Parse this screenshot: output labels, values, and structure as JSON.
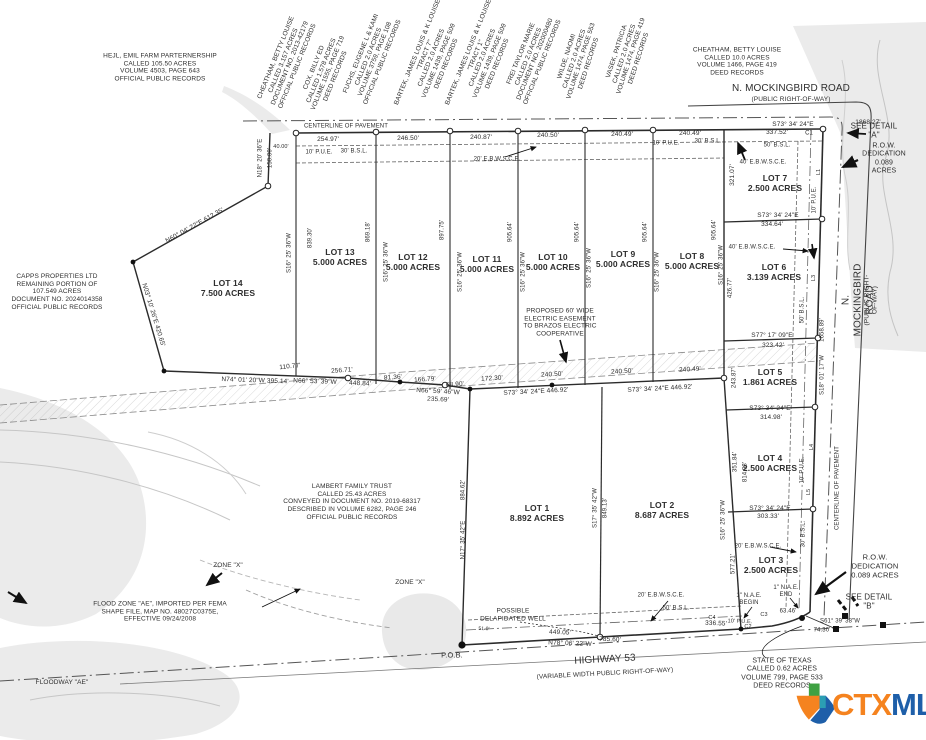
{
  "logo": {
    "ctx": "CTX",
    "mls": "MLS",
    "orange": "#F5831F",
    "blue": "#1E5FA9",
    "green": "#3FA142"
  },
  "annotations": [
    {
      "name": "owner-hejl",
      "text": "HEJL, EMIL FARM PARTERNERSHIP\nCALLED 105.50 ACRES\nVOLUME 4503, PAGE 643\nOFFICIAL PUBLIC RECORDS",
      "x": 160,
      "y": 68
    },
    {
      "name": "owner-cheatham-west",
      "text": "CHEATHAM, BETTY LOUISE\nCALLED 3.157 ACRES\nDOCUMENT NO. 2013-42179\nOFFICIAL PUBLIC RECORDS",
      "x": 287,
      "y": 62,
      "rot": -68
    },
    {
      "name": "owner-cox",
      "text": "COX, BILLY ED\nCALLED 1.578 ACRES\nVOLUME 1555, PAGE 719\nDEED RECORDS",
      "x": 325,
      "y": 72,
      "rot": -68
    },
    {
      "name": "owner-fuchs",
      "text": "FUCHS, EUGENE L & KAMI\nCALLED 2.0 ACRES\nVOLUME 3759, PAGE 108\nOFFICIAL PUBLIC RECORDS",
      "x": 372,
      "y": 58,
      "rot": -68
    },
    {
      "name": "owner-bartek-tract7",
      "text": "BARTEK, JAMES LOUIS & K LOUISE\n\"TRACT 7\"\nCALLED 2.0 ACRES\nVOLUME 1439, PAGE 509\nDEED RECORDS",
      "x": 432,
      "y": 58,
      "rot": -68
    },
    {
      "name": "owner-bartek-tract1",
      "text": "BARTEK, JAMES LOUIS & K LOUISE\n\"TRACT 1\"\nCALLED 2.0 ACRES\nVOLUME 1439, PAGE 509\nDEED RECORDS",
      "x": 483,
      "y": 58,
      "rot": -68
    },
    {
      "name": "owner-frei",
      "text": "FREI TAYLOR MARIE\nCALLED 2.0 ACRES\nDOCUMENT NO. 202000480\nOFFICIAL PUBLIC RECORDS",
      "x": 532,
      "y": 58,
      "rot": -68
    },
    {
      "name": "owner-wilde",
      "text": "WILDE, NAOMI\nCALLED 2.0 ACRES\nVOLUME 1474, PAGE 553\nDEED RECORDS",
      "x": 578,
      "y": 60,
      "rot": -72
    },
    {
      "name": "owner-vasek",
      "text": "VASEK, PATRICIA\nCALLED 2.0 ACRES\nVOLUME 1474, PAGE 419\nDEED RECORDS",
      "x": 628,
      "y": 55,
      "rot": -72
    },
    {
      "name": "owner-cheatham-east",
      "text": "CHEATHAM, BETTY LOUISE\nCALLED 10.0 ACRES\nVOLUME 1466, PAGE 419\nDEED RECORDS",
      "x": 737,
      "y": 62
    },
    {
      "name": "owner-capps",
      "text": "CAPPS PROPERTIES LTD\nREMAINING PORTION OF\n107.549 ACRES\nDOCUMENT NO. 2024014358\nOFFICIAL PUBLIC RECORDS",
      "x": 57,
      "y": 292
    },
    {
      "name": "owner-lambert",
      "text": "LAMBERT FAMILY TRUST\nCALLED 25.43 ACRES\nCONVEYED IN DOCUMENT NO. 2019-68317\nDESCRIBED IN VOLUME 6282, PAGE 246\nOFFICIAL PUBLIC RECORDS",
      "x": 352,
      "y": 502
    },
    {
      "name": "owner-state-of-texas",
      "text": "STATE OF TEXAS\nCALLED 0.62  ACRES\nVOLUME 799, PAGE 533\nDEED RECORDS",
      "x": 782,
      "y": 674,
      "fs": 7
    },
    {
      "name": "road-mockingbird-top",
      "text": "N. MOCKINGBIRD ROAD",
      "x": 791,
      "y": 89,
      "fs": 10
    },
    {
      "name": "road-mockingbird-top-sub",
      "text": "(PUBLIC RIGHT-OF-WAY)",
      "x": 791,
      "y": 100,
      "fs": 6.5
    },
    {
      "name": "road-mockingbird-right",
      "text": "N. MOCKINGBIRD ROAD",
      "x": 858,
      "y": 300,
      "rot": -90,
      "fs": 10
    },
    {
      "name": "road-mockingbird-right-sub",
      "text": "(PUBLIC RIGHT-OF-WAY)",
      "x": 871,
      "y": 300,
      "rot": -90,
      "fs": 6.5
    },
    {
      "name": "road-highway-53",
      "text": "HIGHWAY 53",
      "x": 605,
      "y": 660,
      "fs": 10,
      "rot": -3
    },
    {
      "name": "road-highway-53-sub",
      "text": "(VARIABLE WIDTH PUBLIC RIGHT-OF-WAY)",
      "x": 605,
      "y": 674,
      "fs": 6.5,
      "rot": -3
    },
    {
      "name": "centerline-of-pavement-top",
      "text": "CENTERLINE OF PAVEMENT",
      "x": 346,
      "y": 127,
      "fs": 6
    },
    {
      "name": "centerline-of-pavement-right",
      "text": "CENTERLINE OF PAVEMENT",
      "x": 838,
      "y": 488,
      "rot": -90,
      "fs": 6
    },
    {
      "name": "see-detail-a",
      "text": "SEE DETAIL\n\"A\"",
      "x": 874,
      "y": 131,
      "fs": 8
    },
    {
      "name": "row-dedication-top",
      "text": "R.O.W. DEDICATION\n0.089 ACRES",
      "x": 884,
      "y": 159,
      "fs": 7
    },
    {
      "name": "row-dedication-bottom",
      "text": "R.O.W. DEDICATION\n0.089 ACRES",
      "x": 875,
      "y": 567,
      "fs": 7.5
    },
    {
      "name": "see-detail-b",
      "text": "SEE DETAIL\n\"B\"",
      "x": 869,
      "y": 602,
      "fs": 8
    },
    {
      "name": "dim-s73-top",
      "text": "S73° 34' 24\"E",
      "x": 793,
      "y": 125
    },
    {
      "name": "dim-1868",
      "text": "1868.27'",
      "x": 868,
      "y": 123
    },
    {
      "name": "dim-40-00",
      "text": "40.00'",
      "x": 281,
      "y": 147,
      "fs": 5.5
    },
    {
      "name": "dim-254-97",
      "text": "254.97'",
      "x": 328,
      "y": 140
    },
    {
      "name": "pue-10-topleft",
      "text": "10' P.U.E.",
      "x": 319,
      "y": 153,
      "fs": 6
    },
    {
      "name": "bsl-30-topleft",
      "text": "30' B.S.L.",
      "x": 354,
      "y": 152,
      "fs": 6
    },
    {
      "name": "dim-246-50",
      "text": "246.50'",
      "x": 408,
      "y": 139
    },
    {
      "name": "ebwsce-20-top",
      "text": "20' E.B.W.S.C.E.",
      "x": 497,
      "y": 160,
      "fs": 6
    },
    {
      "name": "dim-240-87",
      "text": "240.87'",
      "x": 481,
      "y": 138
    },
    {
      "name": "dim-240-50-top",
      "text": "240.50'",
      "x": 548,
      "y": 136
    },
    {
      "name": "dim-240-49-a",
      "text": "240.49'",
      "x": 622,
      "y": 135
    },
    {
      "name": "dim-240-49-b",
      "text": "240.49'",
      "x": 690,
      "y": 134
    },
    {
      "name": "dim-337-52",
      "text": "337.52'",
      "x": 777,
      "y": 133
    },
    {
      "name": "curve-c1",
      "text": "C1",
      "x": 809,
      "y": 134,
      "fs": 6
    },
    {
      "name": "pue-10-topright",
      "text": "10' P.U.E.",
      "x": 666,
      "y": 144,
      "fs": 6
    },
    {
      "name": "bsl-30-topright",
      "text": "30' B.S.L.",
      "x": 708,
      "y": 142,
      "fs": 6
    },
    {
      "name": "bsl-50-lot7",
      "text": "50' B.S.L.",
      "x": 777,
      "y": 146,
      "fs": 6
    },
    {
      "name": "ebwsce-40-lot7",
      "text": "40' E.B.W.S.C.E.",
      "x": 763,
      "y": 163,
      "fs": 6
    },
    {
      "name": "dim-321-07",
      "text": "321.07'",
      "x": 733,
      "y": 175,
      "rot": -90
    },
    {
      "name": "lot7-label",
      "text": "LOT 7\n2.500 ACRES",
      "x": 775,
      "y": 183,
      "fs": 8.5,
      "bold": true
    },
    {
      "name": "dim-s73-lot7",
      "text": "S73° 34' 24\"E",
      "x": 778,
      "y": 216
    },
    {
      "name": "dim-334-64",
      "text": "334.64'",
      "x": 772,
      "y": 225
    },
    {
      "name": "ebwsce-40-lot6",
      "text": "40' E.B.W.S.C.E.",
      "x": 752,
      "y": 248,
      "fs": 6
    },
    {
      "name": "lot6-label",
      "text": "LOT 6\n3.139 ACRES",
      "x": 774,
      "y": 272,
      "fs": 8.5,
      "bold": true
    },
    {
      "name": "bsl-50-lot6",
      "text": "50' B.S.L.",
      "x": 803,
      "y": 310,
      "rot": -90,
      "fs": 6
    },
    {
      "name": "pue-10-right-upper",
      "text": "10' P.U.E.",
      "x": 815,
      "y": 200,
      "rot": -90,
      "fs": 6
    },
    {
      "name": "line-l1",
      "text": "L1",
      "x": 819,
      "y": 172,
      "rot": -90,
      "fs": 5.5
    },
    {
      "name": "dim-s77-17-09",
      "text": "S77° 17' 09\"E",
      "x": 772,
      "y": 336
    },
    {
      "name": "dim-323-42",
      "text": "323.42'",
      "x": 773,
      "y": 346
    },
    {
      "name": "lot5-label",
      "text": "LOT 5\n1.861 ACRES",
      "x": 770,
      "y": 377,
      "fs": 8.5,
      "bold": true
    },
    {
      "name": "dim-s73-lot5",
      "text": "S73° 34' 24\"E",
      "x": 770,
      "y": 409
    },
    {
      "name": "dim-314-98",
      "text": "314.98'",
      "x": 771,
      "y": 418
    },
    {
      "name": "lot4-label",
      "text": "LOT 4\n2.500 ACRES",
      "x": 770,
      "y": 463,
      "fs": 8.5,
      "bold": true
    },
    {
      "name": "dim-s73-lot4",
      "text": "S73° 34' 24\"E",
      "x": 770,
      "y": 509
    },
    {
      "name": "dim-303-33",
      "text": "303.33'",
      "x": 768,
      "y": 517
    },
    {
      "name": "lot3-label",
      "text": "LOT 3\n2.500 ACRES",
      "x": 771,
      "y": 565,
      "fs": 8.5,
      "bold": true
    },
    {
      "name": "ebwsce-20-lot3",
      "text": "20' E.B.W.S.C.E.",
      "x": 758,
      "y": 547,
      "fs": 6
    },
    {
      "name": "bsl-30-lot3",
      "text": "30' B.S.L.",
      "x": 804,
      "y": 534,
      "rot": -90,
      "fs": 6
    },
    {
      "name": "dim-243-87",
      "text": "243.87'",
      "x": 735,
      "y": 378,
      "rot": -90,
      "fs": 6
    },
    {
      "name": "dim-351-84",
      "text": "351.84'",
      "x": 736,
      "y": 462,
      "rot": -90,
      "fs": 6
    },
    {
      "name": "dim-814-98",
      "text": "814.98'",
      "x": 746,
      "y": 472,
      "rot": -90,
      "fs": 6
    },
    {
      "name": "dim-s16-lot3",
      "text": "S16° 25' 36\"W",
      "x": 724,
      "y": 520,
      "rot": -90,
      "fs": 6
    },
    {
      "name": "dim-577-21",
      "text": "577.21'",
      "x": 734,
      "y": 564,
      "rot": -90,
      "fs": 6
    },
    {
      "name": "dim-s18-01-17",
      "text": "S18° 01' 17\"W",
      "x": 823,
      "y": 375,
      "rot": -90,
      "fs": 6
    },
    {
      "name": "dim-1658-89",
      "text": "1658.89'",
      "x": 823,
      "y": 330,
      "rot": -90,
      "fs": 6
    },
    {
      "name": "pue-10-right-lower",
      "text": "10' P.U.E.",
      "x": 803,
      "y": 470,
      "rot": -90,
      "fs": 6
    },
    {
      "name": "line-l3",
      "text": "L3",
      "x": 814,
      "y": 278,
      "rot": -90,
      "fs": 5.5
    },
    {
      "name": "line-l4",
      "text": "L4",
      "x": 812,
      "y": 447,
      "rot": -90,
      "fs": 5.5
    },
    {
      "name": "line-l5",
      "text": "L5",
      "x": 809,
      "y": 492,
      "rot": -90,
      "fs": 5.5
    },
    {
      "name": "nae-begin",
      "text": "1\" N.A.E.\nBEGIN",
      "x": 749,
      "y": 600,
      "fs": 6
    },
    {
      "name": "nae-end",
      "text": "1\" N.A.E.\nEND",
      "x": 786,
      "y": 592,
      "fs": 6
    },
    {
      "name": "dim-63-46",
      "text": "63.46'",
      "x": 788,
      "y": 612,
      "fs": 6
    },
    {
      "name": "curve-c3",
      "text": "C3",
      "x": 764,
      "y": 615,
      "fs": 5.5
    },
    {
      "name": "curve-c4",
      "text": "C4",
      "x": 712,
      "y": 618,
      "fs": 5.5
    },
    {
      "name": "curve-c2",
      "text": "C2",
      "x": 748,
      "y": 627,
      "fs": 5.5
    },
    {
      "name": "dim-s61-39-38",
      "text": "S61° 39' 38\"W",
      "x": 840,
      "y": 622,
      "fs": 6
    },
    {
      "name": "dim-74-30",
      "text": "74.30'",
      "x": 822,
      "y": 631,
      "fs": 6
    },
    {
      "name": "lot1-label",
      "text": "LOT 1\n8.892 ACRES",
      "x": 537,
      "y": 513,
      "fs": 8.5,
      "bold": true
    },
    {
      "name": "lot2-label",
      "text": "LOT 2\n8.687 ACRES",
      "x": 662,
      "y": 510,
      "fs": 8.5,
      "bold": true
    },
    {
      "name": "dim-n17-35-42",
      "text": "N17° 35' 42\"E",
      "x": 464,
      "y": 540,
      "rot": -90,
      "fs": 6
    },
    {
      "name": "dim-884-62",
      "text": "884.62'",
      "x": 464,
      "y": 490,
      "rot": -90,
      "fs": 6
    },
    {
      "name": "dim-s17-35-42",
      "text": "S17° 35' 42\"W",
      "x": 596,
      "y": 508,
      "rot": -90,
      "fs": 6
    },
    {
      "name": "dim-849-13",
      "text": "849.13'",
      "x": 606,
      "y": 508,
      "rot": -90,
      "fs": 6
    },
    {
      "name": "note-proposed-easement",
      "text": "PROPOSED 60' WIDE\nELECTRIC EASEMENT\nTO BRAZOS ELECTRIC\nCOOPERATIVE",
      "x": 560,
      "y": 323
    },
    {
      "name": "note-possible-well",
      "text": "POSSIBLE\nDELAPIDATED WELL",
      "x": 513,
      "y": 615,
      "fs": 6.5
    },
    {
      "name": "dim-449-05",
      "text": "449.05'",
      "x": 560,
      "y": 633,
      "rot": 2
    },
    {
      "name": "dim-n78-06-22",
      "text": "N78° 06' 22\"W",
      "x": 570,
      "y": 644,
      "rot": 2
    },
    {
      "name": "dim-785-60",
      "text": "785.60'",
      "x": 610,
      "y": 640,
      "rot": 2
    },
    {
      "name": "dim-336-55",
      "text": "336.55'",
      "x": 716,
      "y": 624,
      "rot": 2
    },
    {
      "name": "pue-10-bottom",
      "text": "10' P.U.E.",
      "x": 740,
      "y": 622,
      "rot": 2,
      "fs": 5.5
    },
    {
      "name": "ebwsce-20-bottom",
      "text": "20' E.B.W.S.C.E.",
      "x": 661,
      "y": 596,
      "fs": 6
    },
    {
      "name": "bsl-50-bottom",
      "text": "50' B.S.L.",
      "x": 676,
      "y": 609,
      "fs": 6
    },
    {
      "name": "pob-label",
      "text": "P.O.B.",
      "x": 452,
      "y": 656,
      "fs": 7.5
    },
    {
      "name": "dim-51-0",
      "text": "51.0'",
      "x": 484,
      "y": 630,
      "fs": 5,
      "rot": 2
    },
    {
      "name": "note-flood-zone",
      "text": "FLOOD ZONE \"AE\", IMPORTED PER FEMA\nSHAPE FILE, MAP NO. 48027C0375E,\nEFFECTIVE 09/24/2008",
      "x": 160,
      "y": 612
    },
    {
      "name": "note-floodway-ae",
      "text": "FLOODWAY \"AE\"",
      "x": 62,
      "y": 683,
      "fs": 6.5
    },
    {
      "name": "note-zone-x-1",
      "text": "ZONE \"X\"",
      "x": 228,
      "y": 566,
      "fs": 6.5
    },
    {
      "name": "note-zone-x-2",
      "text": "ZONE \"X\"",
      "x": 410,
      "y": 583,
      "fs": 6.5
    },
    {
      "name": "lot14-label",
      "text": "LOT 14\n7.500 ACRES",
      "x": 228,
      "y": 288,
      "fs": 8.5,
      "bold": true
    },
    {
      "name": "lot13-label",
      "text": "LOT 13\n5.000 ACRES",
      "x": 340,
      "y": 257,
      "fs": 8.5,
      "bold": true
    },
    {
      "name": "lot12-label",
      "text": "LOT 12\n5.000 ACRES",
      "x": 413,
      "y": 262,
      "fs": 8.5,
      "bold": true
    },
    {
      "name": "lot11-label",
      "text": "LOT 11\n5.000 ACRES",
      "x": 487,
      "y": 264,
      "fs": 8.5,
      "bold": true
    },
    {
      "name": "lot10-label",
      "text": "LOT 10\n5.000 ACRES",
      "x": 553,
      "y": 262,
      "fs": 8.5,
      "bold": true
    },
    {
      "name": "lot9-label",
      "text": "LOT 9\n5.000 ACRES",
      "x": 623,
      "y": 259,
      "fs": 8.5,
      "bold": true
    },
    {
      "name": "lot8-label",
      "text": "LOT 8\n5.000 ACRES",
      "x": 692,
      "y": 261,
      "fs": 8.5,
      "bold": true
    },
    {
      "name": "dim-n60-04-22",
      "text": "N60° 04' 22\"E   612.35'",
      "x": 195,
      "y": 226,
      "rot": -29
    },
    {
      "name": "dim-n03-10-26",
      "text": "N03° 10' 26\"E   420.65'",
      "x": 153,
      "y": 315,
      "rot": 73
    },
    {
      "name": "dim-n18-20-36",
      "text": "N18° 20' 36\"E",
      "x": 261,
      "y": 158,
      "rot": -90,
      "fs": 6
    },
    {
      "name": "dim-150-00",
      "text": "150.00'",
      "x": 271,
      "y": 158,
      "rot": -90,
      "fs": 6
    },
    {
      "name": "dim-n74-01-20",
      "text": "N74° 01' 20\"W   395.14'",
      "x": 255,
      "y": 381,
      "rot": 2
    },
    {
      "name": "dim-110-77",
      "text": "110.77'",
      "x": 290,
      "y": 367,
      "rot": -6
    },
    {
      "name": "dim-256-71",
      "text": "256.71'",
      "x": 342,
      "y": 371,
      "rot": -4
    },
    {
      "name": "dim-n66-53-39",
      "text": "N66° 53' 39\"W",
      "x": 315,
      "y": 382,
      "rot": 2
    },
    {
      "name": "dim-448-84",
      "text": "448.84'",
      "x": 360,
      "y": 384,
      "rot": 2
    },
    {
      "name": "dim-81-36",
      "text": "81.36'",
      "x": 393,
      "y": 378,
      "rot": -4
    },
    {
      "name": "dim-166-79",
      "text": "166.79'",
      "x": 425,
      "y": 380,
      "rot": -4
    },
    {
      "name": "dim-68-90",
      "text": "68.90'",
      "x": 455,
      "y": 385,
      "rot": -4
    },
    {
      "name": "dim-n66-59-46",
      "text": "N66° 59' 46\"W",
      "x": 438,
      "y": 392,
      "rot": 3
    },
    {
      "name": "dim-235-69",
      "text": "235.69'",
      "x": 438,
      "y": 400,
      "rot": 3
    },
    {
      "name": "dim-172-30",
      "text": "172.30'",
      "x": 492,
      "y": 379,
      "rot": -3
    },
    {
      "name": "dim-240-50-mid-a",
      "text": "240.50'",
      "x": 552,
      "y": 375,
      "rot": -3
    },
    {
      "name": "dim-s73-446-92-a",
      "text": "S73° 34' 24\"E   446.92'",
      "x": 536,
      "y": 392,
      "rot": -3
    },
    {
      "name": "dim-240-50-mid-b",
      "text": "240.50'",
      "x": 622,
      "y": 372,
      "rot": -3
    },
    {
      "name": "dim-s73-446-92-b",
      "text": "S73° 34' 24\"E   446.92'",
      "x": 660,
      "y": 389,
      "rot": -3
    },
    {
      "name": "dim-240-49-mid",
      "text": "240.49'",
      "x": 690,
      "y": 370,
      "rot": -3
    },
    {
      "name": "dim-s16-lot13w",
      "text": "S16° 25' 36\"W",
      "x": 290,
      "y": 253,
      "rot": -90,
      "fs": 6
    },
    {
      "name": "dim-839-30",
      "text": "839.30'",
      "x": 311,
      "y": 238,
      "rot": -90,
      "fs": 6
    },
    {
      "name": "dim-869-18",
      "text": "869.18'",
      "x": 369,
      "y": 232,
      "rot": -90,
      "fs": 6
    },
    {
      "name": "dim-s16-line-13-12",
      "text": "S16° 25' 36\"W",
      "x": 387,
      "y": 262,
      "rot": -90,
      "fs": 6
    },
    {
      "name": "dim-897-75",
      "text": "897.75'",
      "x": 443,
      "y": 230,
      "rot": -90,
      "fs": 6
    },
    {
      "name": "dim-s16-line-12-11",
      "text": "S16° 25' 36\"W",
      "x": 461,
      "y": 272,
      "rot": -90,
      "fs": 6
    },
    {
      "name": "dim-905-64-a",
      "text": "905.64'",
      "x": 511,
      "y": 232,
      "rot": -90,
      "fs": 6
    },
    {
      "name": "dim-s16-line-11-10",
      "text": "S16° 25' 36\"W",
      "x": 524,
      "y": 272,
      "rot": -90,
      "fs": 6
    },
    {
      "name": "dim-905-64-b",
      "text": "905.64'",
      "x": 578,
      "y": 232,
      "rot": -90,
      "fs": 6
    },
    {
      "name": "dim-s16-line-10-9",
      "text": "S16° 25' 36\"W",
      "x": 590,
      "y": 268,
      "rot": -90,
      "fs": 6
    },
    {
      "name": "dim-905-64-c",
      "text": "905.64'",
      "x": 646,
      "y": 232,
      "rot": -90,
      "fs": 6
    },
    {
      "name": "dim-s16-line-9-8",
      "text": "S16° 25' 36\"W",
      "x": 658,
      "y": 272,
      "rot": -90,
      "fs": 6
    },
    {
      "name": "dim-905-64-d",
      "text": "905.64'",
      "x": 715,
      "y": 230,
      "rot": -90,
      "fs": 6
    },
    {
      "name": "dim-s16-line-8-7",
      "text": "S16° 25' 36\"W",
      "x": 722,
      "y": 265,
      "rot": -90,
      "fs": 6
    },
    {
      "name": "dim-426-77",
      "text": "426.77'",
      "x": 731,
      "y": 288,
      "rot": -90,
      "fs": 6
    }
  ]
}
